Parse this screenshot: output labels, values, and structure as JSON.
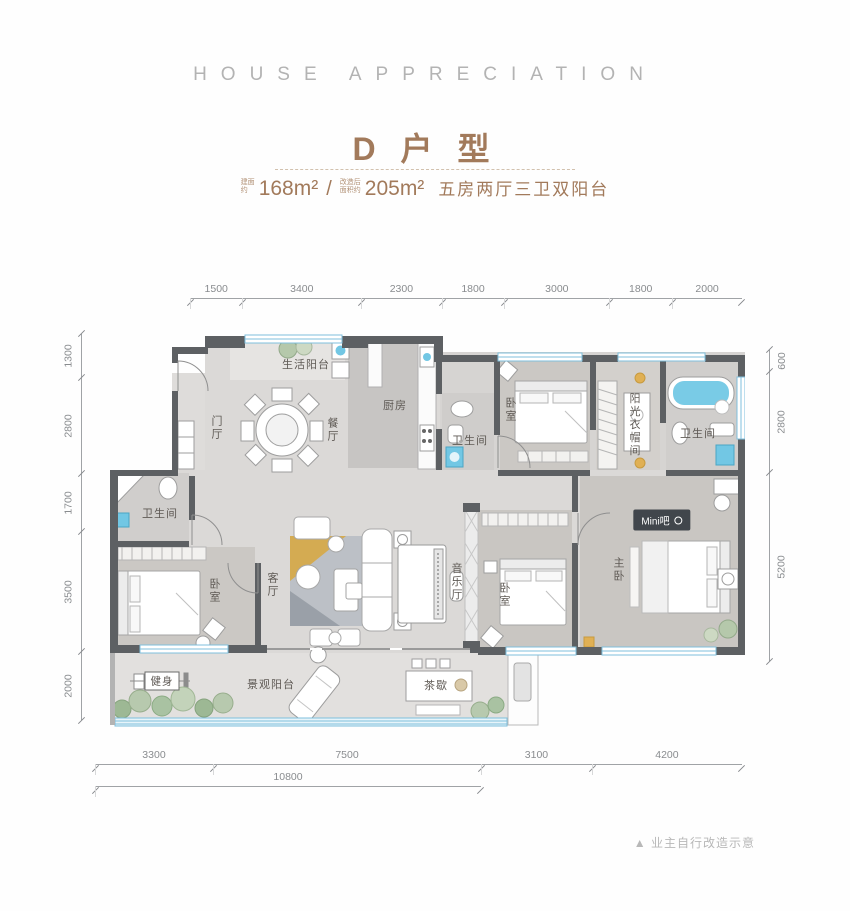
{
  "header": {
    "eyebrow": "HOUSE APPRECIATION",
    "title": "D 户 型",
    "area1_prefix_line1": "建面",
    "area1_prefix_line2": "约",
    "area1": "168m²",
    "slash": "/",
    "area2_prefix_line1": "改造后",
    "area2_prefix_line2": "面积约",
    "area2": "205m²",
    "desc": "五房两厅三卫双阳台"
  },
  "plan": {
    "rooms": [
      {
        "label": "生活阳台"
      },
      {
        "label": "门厅"
      },
      {
        "label": "餐厅"
      },
      {
        "label": "厨房"
      },
      {
        "label": "卫生间"
      },
      {
        "label": "卧室"
      },
      {
        "label": "阳光衣帽间"
      },
      {
        "label": "卫生间"
      },
      {
        "label": "卫生间"
      },
      {
        "label": "卧室"
      },
      {
        "label": "客厅"
      },
      {
        "label": "音乐厅"
      },
      {
        "label": "卧室"
      },
      {
        "label": "主卧"
      },
      {
        "label": "Mini吧"
      },
      {
        "label": "健身"
      },
      {
        "label": "景观阳台"
      },
      {
        "label": "茶歇"
      }
    ]
  },
  "dims": {
    "top": [
      1500,
      3400,
      2300,
      1800,
      3000,
      1800,
      2000
    ],
    "left": [
      1300,
      2800,
      1700,
      3500,
      2000
    ],
    "right": [
      600,
      2800,
      5200
    ],
    "bottom": [
      3300,
      7500,
      3100,
      4200
    ],
    "bottom_total": [
      10800
    ]
  },
  "note": "▲ 业主自行改造示意",
  "colors": {
    "accent_brown": "#a27a5b",
    "wall_gray": "#5d6063",
    "window_blue": "#7fbfdc",
    "water_blue": "#72c7e4",
    "gold": "#e0b054"
  }
}
